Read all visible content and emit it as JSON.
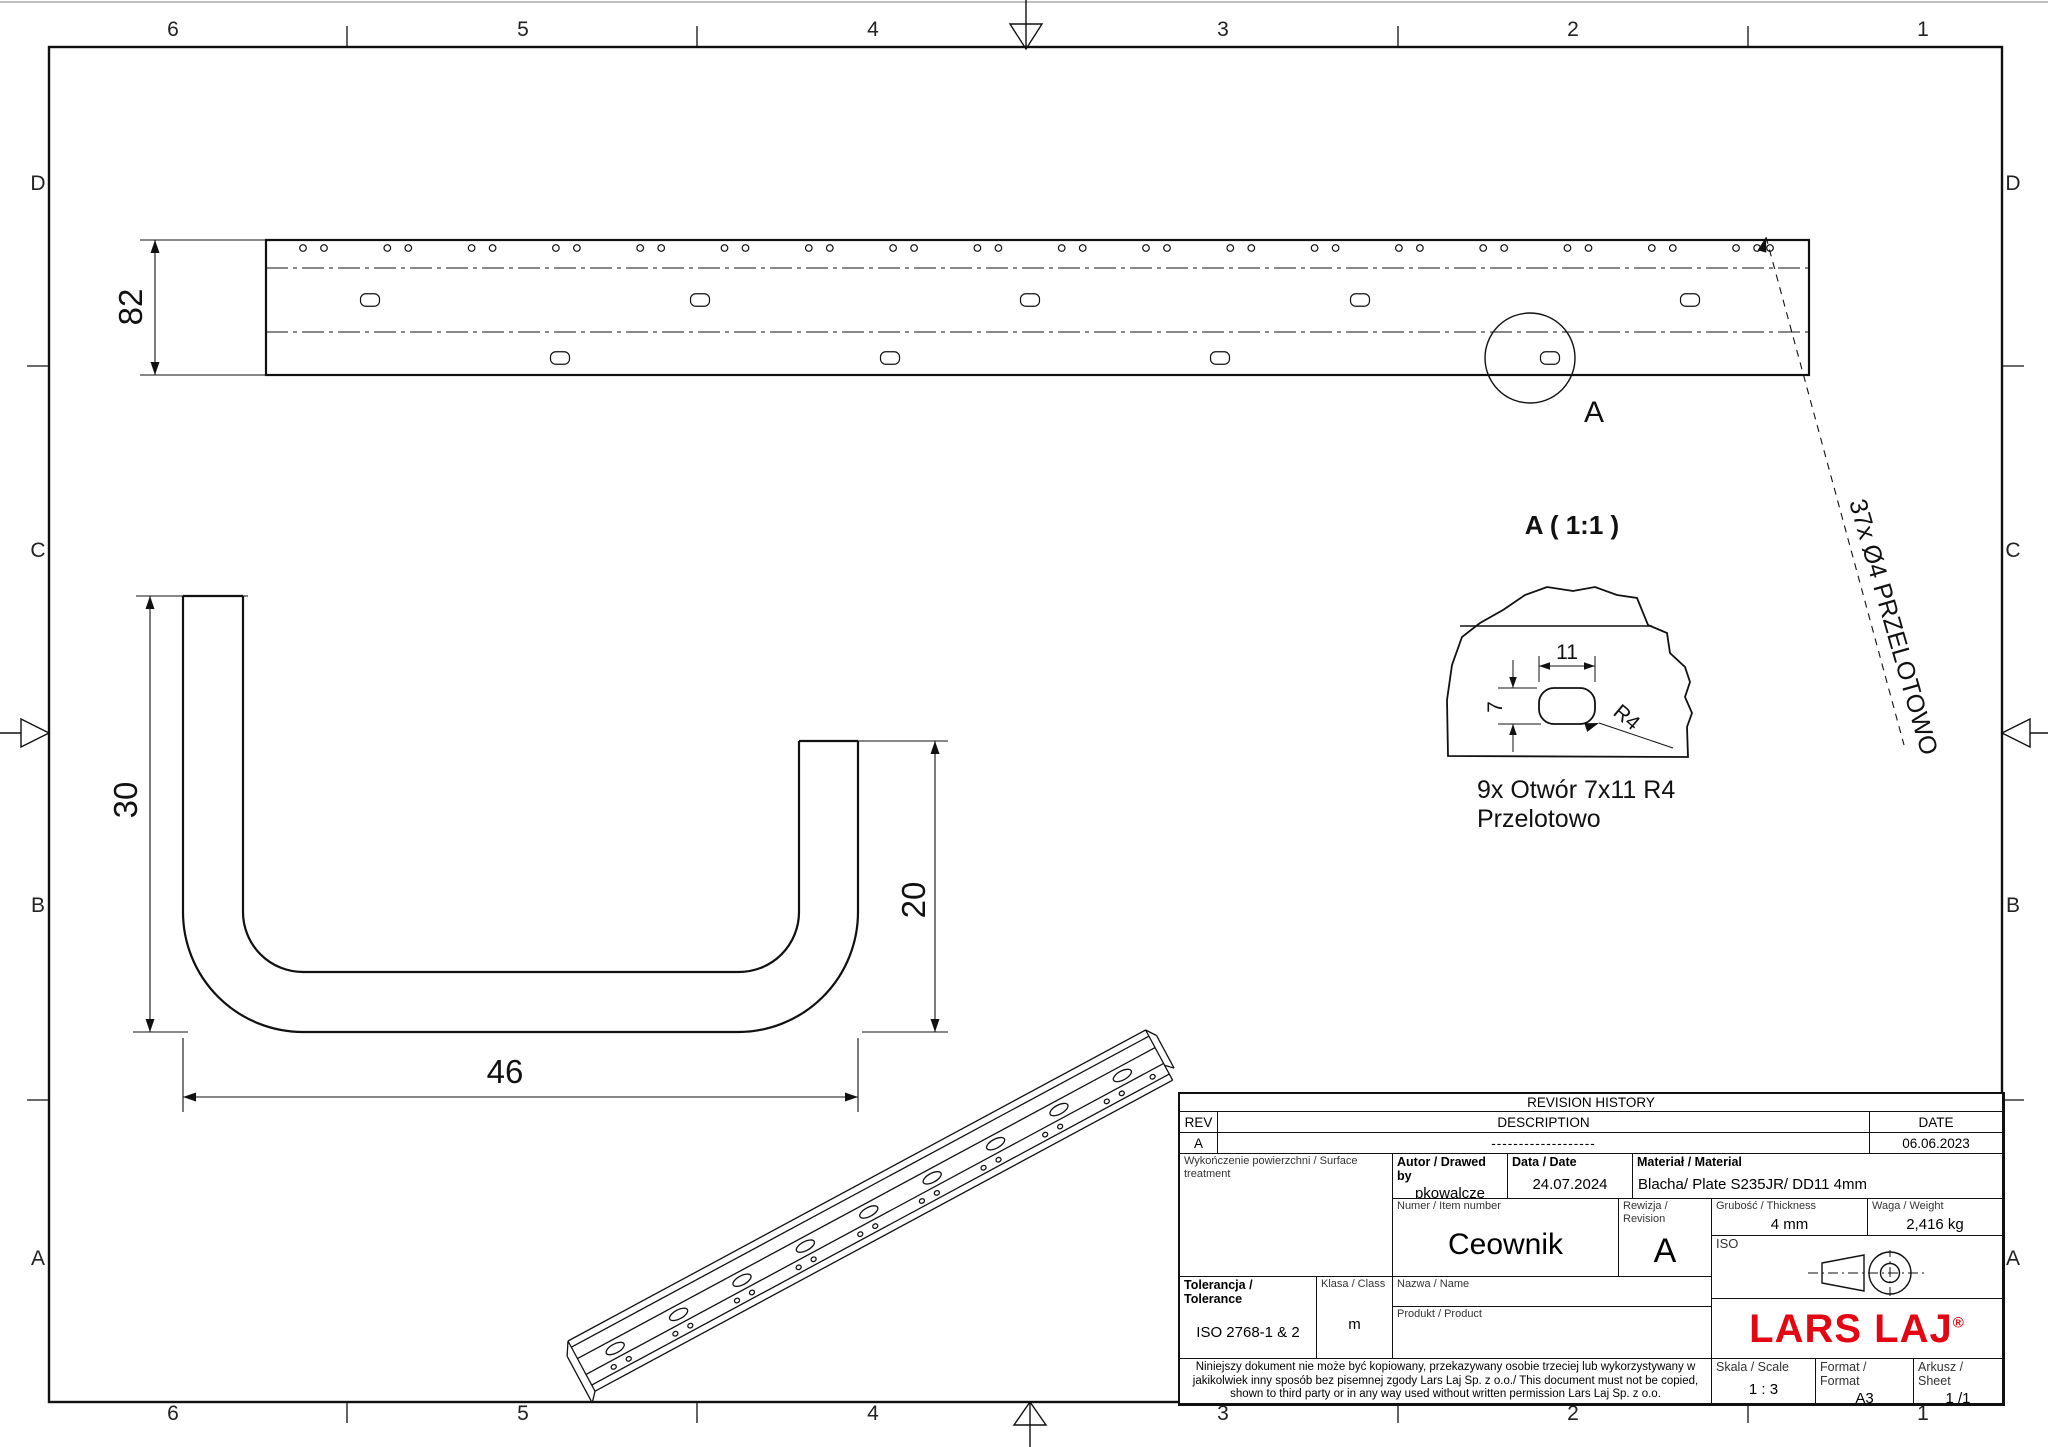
{
  "zones": {
    "columns": [
      "6",
      "5",
      "4",
      "3",
      "2",
      "1"
    ],
    "rows": [
      "D",
      "C",
      "B",
      "A"
    ]
  },
  "drawing_labels": {
    "dim_82": "82",
    "dim_30": "30",
    "dim_20": "20",
    "dim_46": "46",
    "dim_11": "11",
    "dim_7": "7",
    "radius": "R4",
    "detail_title": "A ( 1:1 )",
    "detail_marker": "A",
    "note_line1": "9x Otwór 7x11 R4",
    "note_line2": "Przelotowo",
    "leader_note": "37x Ø4 PRZELOTOWO"
  },
  "drawing": {
    "flat": {
      "left": 266,
      "right": 1809,
      "top": 240,
      "bottom": 375,
      "bend1": 268,
      "bend2": 332,
      "hole_row_y": 248,
      "hole_r": 3.3,
      "pair_start": 303,
      "pair_step": 84.3,
      "pair_gap": 21,
      "pair_count": 18,
      "single_x": 1770,
      "slot_w": 19,
      "slot_h": 12.5,
      "slots_mid": {
        "y": 300,
        "xs": [
          370,
          700,
          1030,
          1360,
          1690
        ]
      },
      "slots_bot": {
        "y": 358,
        "xs": [
          560,
          890,
          1220,
          1550
        ]
      }
    },
    "iso": {
      "x": 568,
      "y": 1341,
      "angle": -28.3,
      "len": 656,
      "line_offsets": [
        0,
        7,
        20,
        38,
        50,
        57
      ],
      "slot_row_y": 29,
      "slot_start": 38,
      "slot_step": 72,
      "slot_count": 9,
      "pair_row_y": 44.5,
      "pair_start": 28,
      "pair_step": 70,
      "pair_gap": 17,
      "pair_count": 9,
      "single_x": 640
    }
  },
  "title_block": {
    "revision_history": {
      "title": "REVISION HISTORY",
      "col_rev": "REV",
      "col_description": "DESCRIPTION",
      "col_date": "DATE",
      "row": {
        "rev": "A",
        "description": "-------------------",
        "date": "06.06.2023"
      }
    },
    "surface": {
      "label": "Wykończenie powierzchni / Surface treatment"
    },
    "author": {
      "label": "Autor / Drawed by",
      "value": "pkowalcze"
    },
    "date": {
      "label": "Data / Date",
      "value": "24.07.2024"
    },
    "material": {
      "label": "Materiał / Material",
      "value": "Blacha/ Plate S235JR/ DD11 4mm"
    },
    "item": {
      "label": "Numer / Item number",
      "value": "Ceownik"
    },
    "revision": {
      "label": "Rewizja / Revision",
      "value": "A"
    },
    "thickness": {
      "label": "Grubość / Thickness",
      "value": "4 mm"
    },
    "weight": {
      "label": "Waga / Weight",
      "value": "2,416 kg"
    },
    "iso_label": "ISO",
    "tolerance": {
      "label": "Tolerancja / Tolerance",
      "value": "ISO 2768-1 & 2"
    },
    "class": {
      "label": "Klasa / Class",
      "value": "m"
    },
    "name": {
      "label": "Nazwa / Name"
    },
    "product": {
      "label": "Produkt / Product"
    },
    "logo": {
      "text": "LARS LAJ",
      "reg": "®",
      "color": "#e30613"
    },
    "disclaimer": {
      "line1": "Niniejszy dokument nie może być kopiowany, przekazywany osobie trzeciej lub wykorzystywany w",
      "line2": "jakikolwiek inny sposób bez pisemnej zgody Lars Laj Sp. z o.o./ This document must not be copied,",
      "line3": "shown to third party or in any way used without written permission Lars Laj Sp. z o.o."
    },
    "scale": {
      "label": "Skala / Scale",
      "value": "1 : 3"
    },
    "format": {
      "label": "Format / Format",
      "value": "A3"
    },
    "sheet": {
      "label": "Arkusz / Sheet",
      "value": "1 /1"
    }
  }
}
